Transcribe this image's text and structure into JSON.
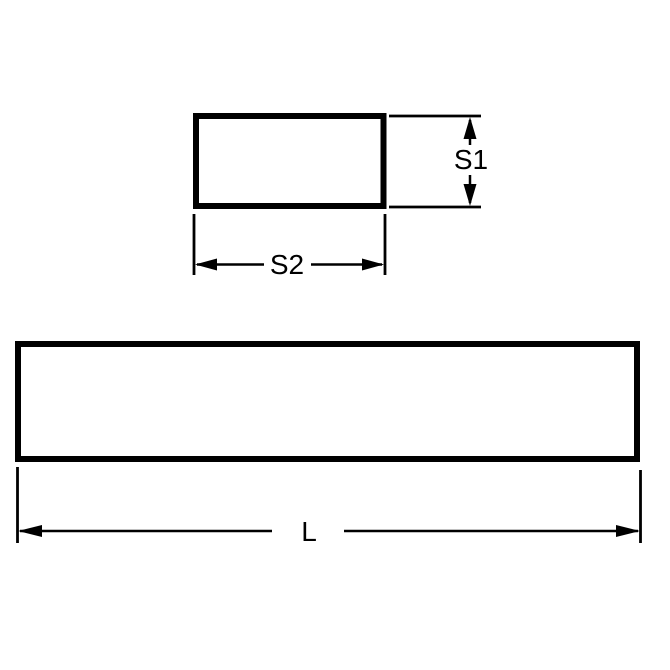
{
  "diagram": {
    "background_color": "#ffffff",
    "line_color": "#000000",
    "cross_section_view": {
      "height_label": "S1",
      "width_label": "S2"
    },
    "side_view": {
      "length_label": "L"
    }
  }
}
